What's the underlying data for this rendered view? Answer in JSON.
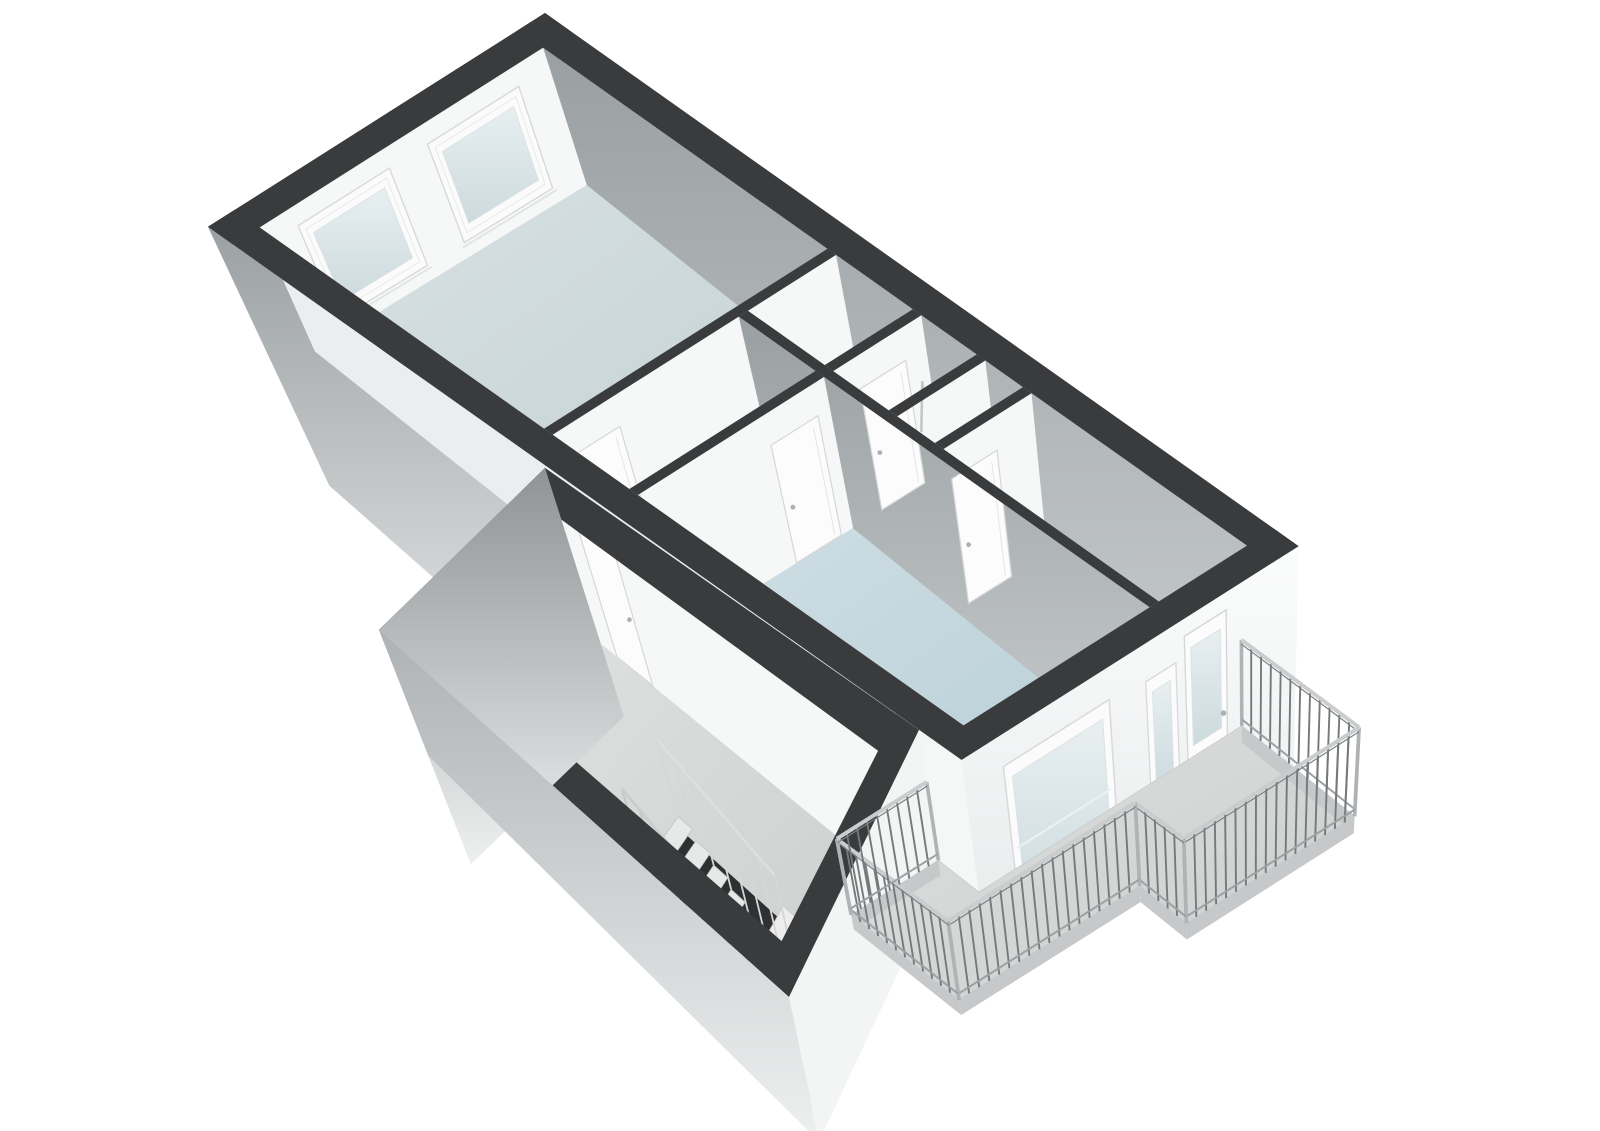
{
  "page": {
    "title": "3D axonometric floor plan render",
    "background": "#ffffff"
  },
  "floorplan": {
    "type": "axonometric-3d-floorplan",
    "volumes": 2,
    "rooms": [
      {
        "id": "living-room",
        "floor": "blue",
        "windows_on_end_wall": 2
      },
      {
        "id": "small-room",
        "floor": "gray",
        "doors": 1
      },
      {
        "id": "bathroom",
        "floor": "gray",
        "fixtures": [
          "shower"
        ]
      },
      {
        "id": "toilet",
        "floor": "gray",
        "doors": 1
      },
      {
        "id": "storage-room",
        "floor": "pale-blue",
        "doors": 1
      },
      {
        "id": "bedroom",
        "floor": "blue",
        "windows": [
          "large",
          "small"
        ]
      },
      {
        "id": "hallway",
        "floor": "gray"
      },
      {
        "id": "stair-room",
        "floor": "gray",
        "fixtures": [
          "staircase-with-balustrade",
          "landing"
        ]
      }
    ],
    "balcony": {
      "shape": "L-stepped",
      "railing": "vertical-balusters",
      "access_door": true,
      "sections": 2
    },
    "interior_doors": 6
  },
  "colors": {
    "background": "#ffffff",
    "wallTop": "#393b3d",
    "intWhite": "#f6f7f7",
    "intWhiteShade": "#ebedee",
    "neFaceTop": "#9aa0a2",
    "neFaceBottom": "#c6cacb",
    "extGrayTop": "#8f9395",
    "extGraySWTop": "#9ba0a2",
    "extLowSWTop": "#aeb2b4",
    "extFadeBottom": "#eef0f0",
    "extWhiteTop": "#fbfcfc",
    "extWhiteBottom": "#e7e9ea",
    "floorLivingA": "#d9e2e4",
    "floorLivingB": "#c0ced2",
    "floorBedA": "#cfdfe4",
    "floorBedB": "#b4ccd4",
    "floorStorA": "#e6edee",
    "floorStorB": "#d5e1e3",
    "floorGrayA": "#dadcdc",
    "floorGrayB": "#c6c9c9",
    "floorCluA": "#cfd2d2",
    "floorCluB": "#bdc0c1",
    "floorLowA": "#e0e1e1",
    "floorLowB": "#c9cbcb",
    "floorBalA": "#dddede",
    "floorBalB": "#cdcfcf",
    "glassA": "#e8eff1",
    "glassB": "#ccdade",
    "frameWhite": "#fbfbfb",
    "frameStroke": "#d7d9da",
    "doorFill": "#fcfcfc",
    "doorStroke": "#d5d7d8",
    "handle": "#aeb1b3",
    "railPost": "#76797b",
    "railRail": "#caccce",
    "railCorner": "#b0b3b5",
    "railDark": "#7c8082",
    "railBottom": "#9ea1a3",
    "fascia": "#c6c8c9",
    "stairTread": "#e7e8e8",
    "stairTreadStroke": "#c2c4c5",
    "stairPit": "#2e3032",
    "landingTop": "#ededee",
    "landingFace": "#d8dada",
    "balconyEdge": "#c8cacb"
  }
}
